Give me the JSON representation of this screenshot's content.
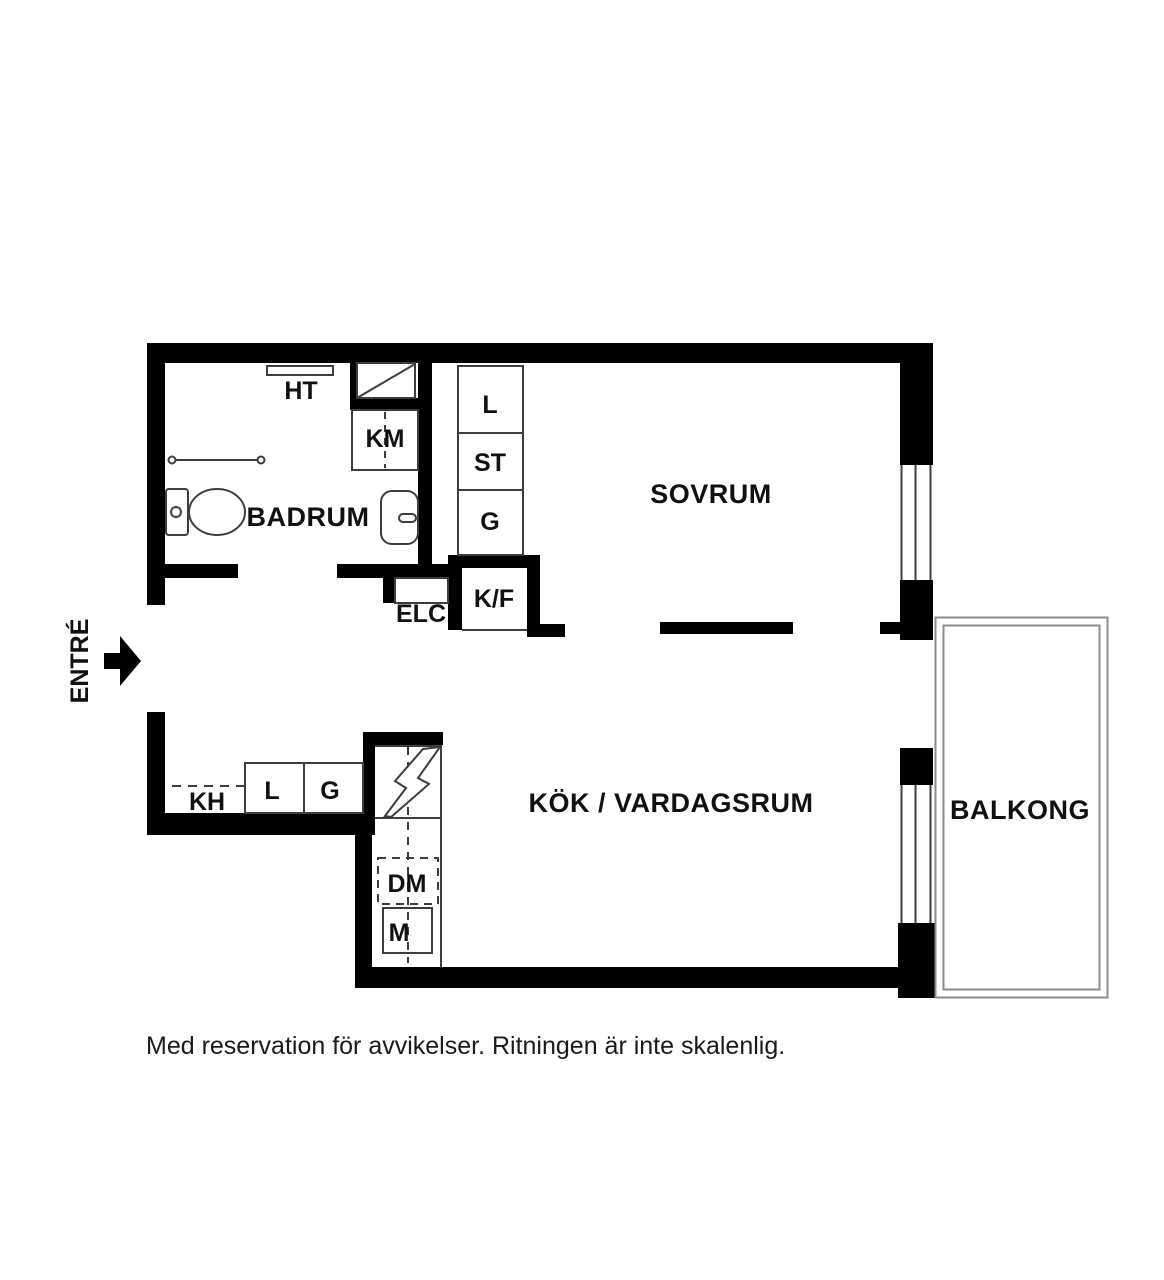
{
  "page": {
    "caption": "Med reservation för avvikelser. Ritningen är inte skalenlig."
  },
  "rooms": {
    "badrum": "BADRUM",
    "sovrum": "SOVRUM",
    "kok_vardagsrum": "KÖK / VARDAGSRUM",
    "balkong": "BALKONG",
    "entre": "ENTRÉ"
  },
  "fixtures": {
    "ht": "HT",
    "km": "KM",
    "l_hall": "L",
    "st": "ST",
    "g_hall": "G",
    "kf": "K/F",
    "elc": "ELC",
    "kh": "KH",
    "l_kitchen": "L",
    "g_kitchen": "G",
    "dm": "DM",
    "m": "M"
  },
  "colors": {
    "wall": "#000000",
    "thin_line": "#3d3d3d",
    "balcony_line": "#8c8c8c",
    "background": "#ffffff",
    "text": "#111111"
  }
}
